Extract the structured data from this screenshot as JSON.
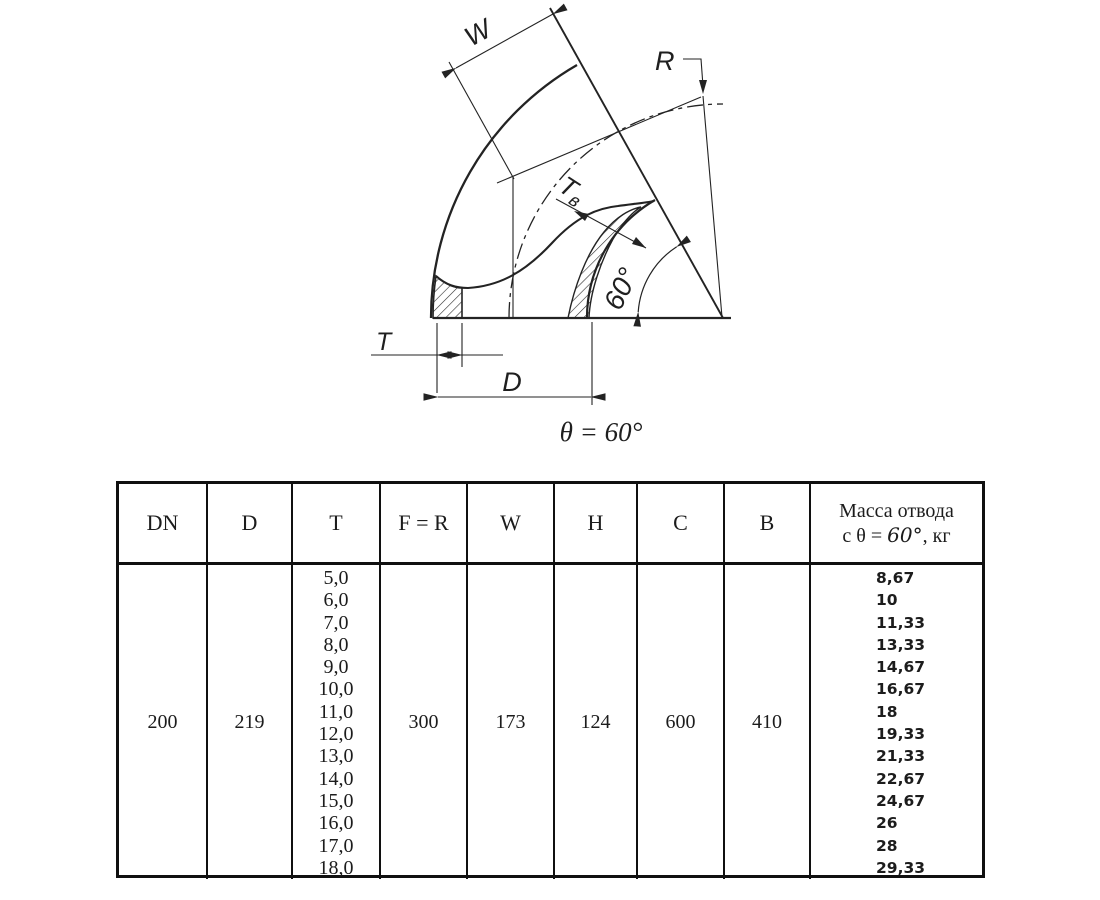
{
  "drawing": {
    "labels": {
      "w": "W",
      "r": "R",
      "tv_main": "Т",
      "tv_sub": "в",
      "t": "T",
      "d": "D",
      "angle": "60°",
      "caption_theta": "θ",
      "caption_eq": " = ",
      "caption_value": "60°"
    }
  },
  "table": {
    "headers": [
      "DN",
      "D",
      "T",
      "F = R",
      "W",
      "H",
      "C",
      "B"
    ],
    "mass_header": {
      "line1": "Масса отвода",
      "prefix": "с θ = ",
      "angle": "60°",
      "suffix": ", кг"
    },
    "values": {
      "dn": "200",
      "d": "219",
      "fr": "300",
      "w": "173",
      "h": "124",
      "c": "600",
      "b": "410"
    },
    "t_values": [
      "5,0",
      "6,0",
      "7,0",
      "8,0",
      "9,0",
      "10,0",
      "11,0",
      "12,0",
      "13,0",
      "14,0",
      "15,0",
      "16,0",
      "17,0",
      "18,0"
    ],
    "mass_values": [
      "8,67",
      "10",
      "11,33",
      "13,33",
      "14,67",
      "16,67",
      "18",
      "19,33",
      "21,33",
      "22,67",
      "24,67",
      "26",
      "28",
      "29,33"
    ]
  },
  "colors": {
    "line": "#232323"
  }
}
